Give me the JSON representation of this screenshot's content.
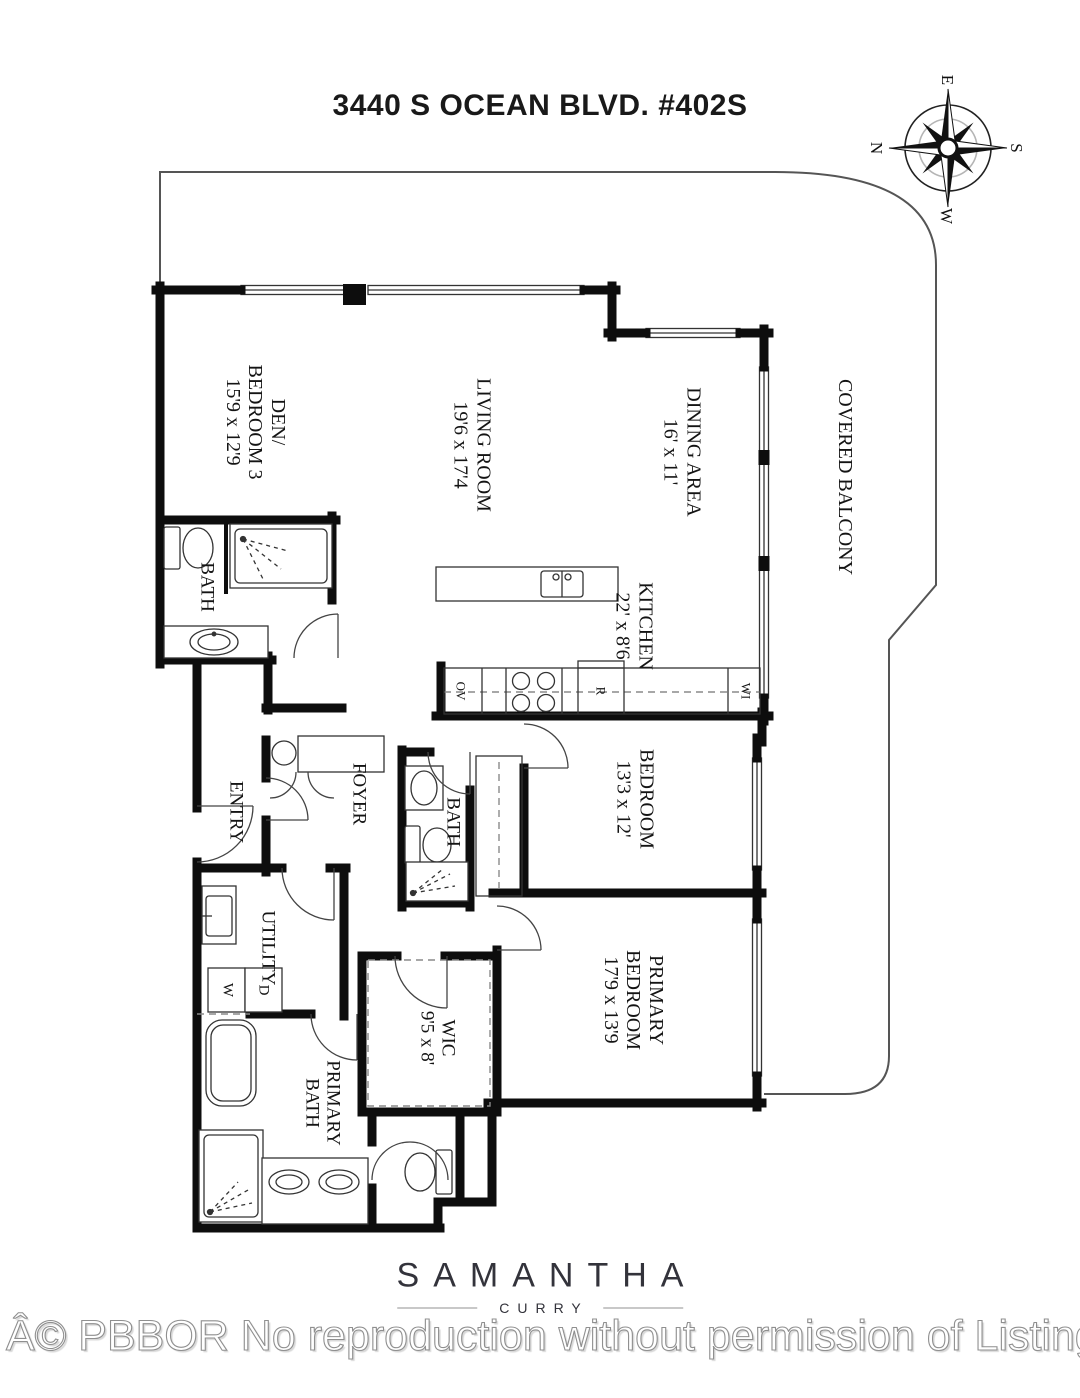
{
  "title": "3440 S OCEAN BLVD. #402S",
  "compass": {
    "n": "N",
    "e": "E",
    "s": "S",
    "w": "W"
  },
  "rooms": {
    "den": {
      "name": "DEN/\nBEDROOM 3",
      "dims": "15'9 x 12'9"
    },
    "living": {
      "name": "LIVING ROOM",
      "dims": "19'6 x 17'4"
    },
    "dining": {
      "name": "DINING AREA",
      "dims": "16' x 11'"
    },
    "balcony": {
      "name": "COVERED BALCONY"
    },
    "kitchen": {
      "name": "KITCHEN",
      "dims": "22' x 8'6"
    },
    "bath1": {
      "name": "BATH"
    },
    "entry": {
      "name": "ENTRY"
    },
    "foyer": {
      "name": "FOYER"
    },
    "bath2": {
      "name": "BATH"
    },
    "bedroom": {
      "name": "BEDROOM",
      "dims": "13'3 x 12'"
    },
    "primary_bedroom": {
      "name": "PRIMARY\nBEDROOM",
      "dims": "17'9 x 13'9"
    },
    "utility": {
      "name": "UTILITY"
    },
    "wic": {
      "name": "WIC",
      "dims": "9'5 x 8'"
    },
    "primary_bath": {
      "name": "PRIMARY\nBATH"
    }
  },
  "fixtures": {
    "oven": "OV",
    "range": "R",
    "wine": "WI",
    "washer": "W",
    "dryer": "D"
  },
  "brand": {
    "name": "SAMANTHA",
    "sub": "CURRY"
  },
  "watermark": "Â© PBBOR No reproduction without permission of Listing Brok"
}
